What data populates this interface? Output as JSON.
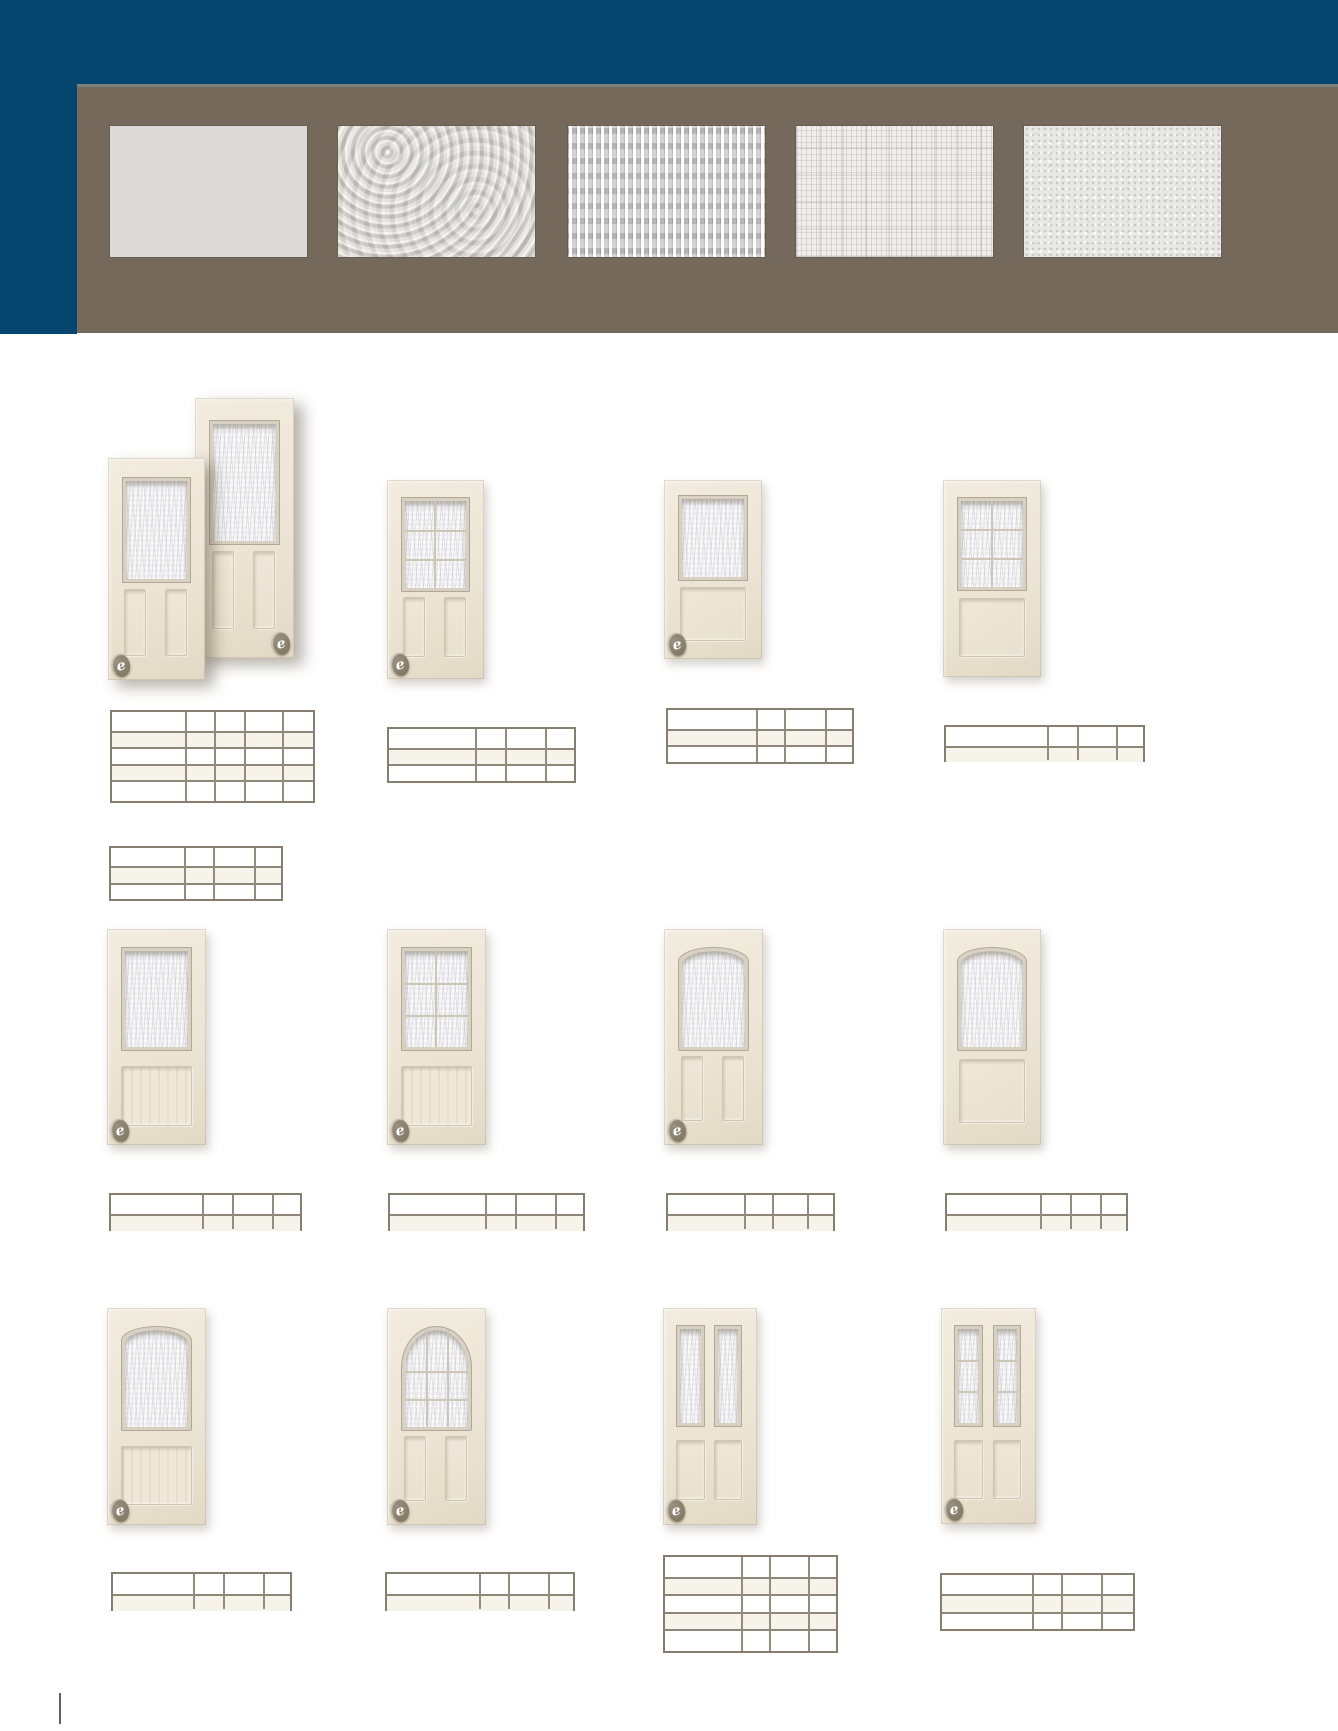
{
  "page": {
    "width": 1338,
    "height": 1731,
    "background": "#ffffff"
  },
  "header": {
    "navy_color": "#05466e",
    "panel_color": "#75695b",
    "panel_top_line_color": "#80807c"
  },
  "logo": {
    "glyph": "e",
    "circle_color": "#8b8172",
    "glyph_color": "#ffffff"
  },
  "swatches": [
    {
      "id": "clear",
      "texture": "flat",
      "x": 110
    },
    {
      "id": "hammered",
      "texture": "hammered",
      "x": 338
    },
    {
      "id": "geometric",
      "texture": "prism",
      "x": 568
    },
    {
      "id": "linen",
      "texture": "linen",
      "x": 796
    },
    {
      "id": "stipple",
      "texture": "stipple",
      "x": 1024
    }
  ],
  "doors": [
    {
      "id": "r1c1-back",
      "x": 195,
      "y": 398,
      "w": 99,
      "h": 260,
      "glass": "rect-textured",
      "bottom": "two-panels",
      "logo": "right",
      "shadow": "big",
      "z": 1
    },
    {
      "id": "r1c1-front",
      "x": 108,
      "y": 458,
      "w": 97,
      "h": 222,
      "glass": "rect-textured",
      "bottom": "two-panels",
      "logo": "left",
      "shadow": "big",
      "z": 2
    },
    {
      "id": "r1c2",
      "x": 387,
      "y": 480,
      "w": 97,
      "h": 199,
      "glass": "rect-grid",
      "bottom": "two-panels",
      "logo": "left"
    },
    {
      "id": "r1c3",
      "x": 664,
      "y": 480,
      "w": 98,
      "h": 179,
      "glass": "rect-textured",
      "bottom": "one-panel",
      "logo": "left"
    },
    {
      "id": "r1c4",
      "x": 943,
      "y": 480,
      "w": 98,
      "h": 197,
      "glass": "rect-grid",
      "bottom": "one-panel",
      "logo": null
    },
    {
      "id": "r2c1",
      "x": 107,
      "y": 929,
      "w": 99,
      "h": 216,
      "glass": "rect-textured",
      "bottom": "beadboard",
      "logo": "left"
    },
    {
      "id": "r2c2",
      "x": 387,
      "y": 929,
      "w": 99,
      "h": 216,
      "glass": "rect-grid",
      "bottom": "beadboard",
      "logo": "left"
    },
    {
      "id": "r2c3",
      "x": 664,
      "y": 929,
      "w": 99,
      "h": 216,
      "glass": "camber-textured",
      "bottom": "two-panels",
      "logo": "left"
    },
    {
      "id": "r2c4",
      "x": 943,
      "y": 929,
      "w": 98,
      "h": 216,
      "glass": "camber-textured",
      "bottom": "one-panel",
      "logo": null
    },
    {
      "id": "r3c1",
      "x": 107,
      "y": 1308,
      "w": 99,
      "h": 217,
      "glass": "camber-textured",
      "bottom": "beadboard",
      "logo": "left"
    },
    {
      "id": "r3c2",
      "x": 387,
      "y": 1308,
      "w": 99,
      "h": 217,
      "glass": "arch-grid",
      "bottom": "two-panels",
      "logo": "left"
    },
    {
      "id": "r3c3",
      "x": 663,
      "y": 1308,
      "w": 94,
      "h": 217,
      "glass": "twin-textured",
      "bottom": "two-panels-small",
      "logo": "left"
    },
    {
      "id": "r3c4",
      "x": 941,
      "y": 1308,
      "w": 95,
      "h": 216,
      "glass": "twin-grid",
      "bottom": "two-panels-small",
      "logo": "left"
    }
  ],
  "tables": [
    {
      "id": "r1c1-a",
      "y": 710,
      "rows": 5,
      "rh": 18.6,
      "cols": [
        110,
        185,
        214,
        244,
        282,
        315
      ],
      "shaded": [
        1,
        3
      ]
    },
    {
      "id": "r1c1-b",
      "y": 846,
      "rows": 3,
      "rh": 18.4,
      "cols": [
        109,
        184,
        213,
        254,
        283
      ],
      "shaded": [
        1
      ]
    },
    {
      "id": "r1c2",
      "y": 727,
      "rows": 3,
      "rh": 18.7,
      "cols": [
        387,
        475,
        505,
        545,
        576
      ],
      "shaded": [
        1
      ]
    },
    {
      "id": "r1c3",
      "y": 708,
      "rows": 3,
      "rh": 18.7,
      "cols": [
        666,
        756,
        784,
        825,
        854
      ],
      "shaded": [
        1
      ]
    },
    {
      "id": "r1c4",
      "y": 725,
      "rows": 2,
      "rh": 18.5,
      "cols": [
        944,
        1047,
        1077,
        1116,
        1145
      ],
      "shaded": [
        1
      ]
    },
    {
      "id": "r2c1",
      "y": 1193,
      "rows": 2,
      "rh": 19,
      "cols": [
        109,
        202,
        232,
        272,
        302
      ],
      "shaded": [
        1
      ]
    },
    {
      "id": "r2c2",
      "y": 1193,
      "rows": 2,
      "rh": 19,
      "cols": [
        388,
        485,
        515,
        555,
        585
      ],
      "shaded": [
        1
      ]
    },
    {
      "id": "r2c3",
      "y": 1193,
      "rows": 2,
      "rh": 19,
      "cols": [
        666,
        744,
        772,
        807,
        835
      ],
      "shaded": [
        1
      ]
    },
    {
      "id": "r2c4",
      "y": 1193,
      "rows": 2,
      "rh": 19,
      "cols": [
        945,
        1040,
        1070,
        1100,
        1128
      ],
      "shaded": [
        1
      ]
    },
    {
      "id": "r3c1",
      "y": 1572,
      "rows": 2,
      "rh": 19.5,
      "cols": [
        111,
        193,
        223,
        263,
        292
      ],
      "shaded": [
        1
      ]
    },
    {
      "id": "r3c2",
      "y": 1572,
      "rows": 2,
      "rh": 19.5,
      "cols": [
        385,
        479,
        508,
        548,
        575
      ],
      "shaded": [
        1
      ]
    },
    {
      "id": "r3c3",
      "y": 1555,
      "rows": 5,
      "rh": 19.6,
      "cols": [
        663,
        741,
        769,
        808,
        838
      ],
      "shaded": [
        1,
        3
      ]
    },
    {
      "id": "r3c4",
      "y": 1573,
      "rows": 3,
      "rh": 19.3,
      "cols": [
        940,
        1032,
        1061,
        1101,
        1135
      ],
      "shaded": [
        1
      ]
    }
  ],
  "page_mark": {
    "x": 59,
    "y": 1693,
    "w": 2,
    "h": 31
  }
}
